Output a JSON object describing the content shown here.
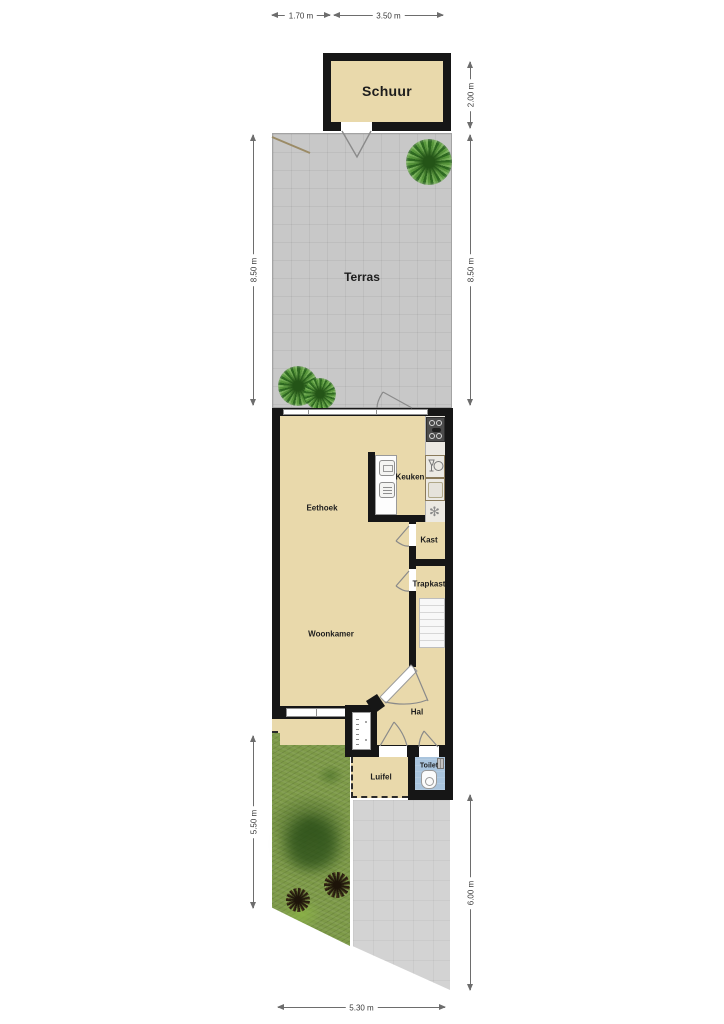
{
  "rooms": {
    "schuur": "Schuur",
    "terras": "Terras",
    "eethoek": "Eethoek",
    "keuken": "Keuken",
    "kast": "Kast",
    "trapkast": "Trapkast",
    "woonkamer": "Woonkamer",
    "hal": "Hal",
    "luifel": "Luifel",
    "toilet": "Toilet"
  },
  "dimensions": {
    "top_left": "1.70 m",
    "top_right": "3.50 m",
    "right_top": "2.00 m",
    "right_middle": "8.50 m",
    "left_middle": "8.50 m",
    "left_bottom": "5.50 m",
    "right_bottom": "6.00 m",
    "bottom": "5.30 m"
  },
  "icons": {
    "flower": "✻"
  },
  "colors": {
    "floor": "#e9d9ab",
    "wall": "#161616",
    "terrace": "#c8c8c8",
    "toilet_floor": "#a9c4dd",
    "grass": "#7d9a48",
    "dimension": "#6d6d6d"
  }
}
